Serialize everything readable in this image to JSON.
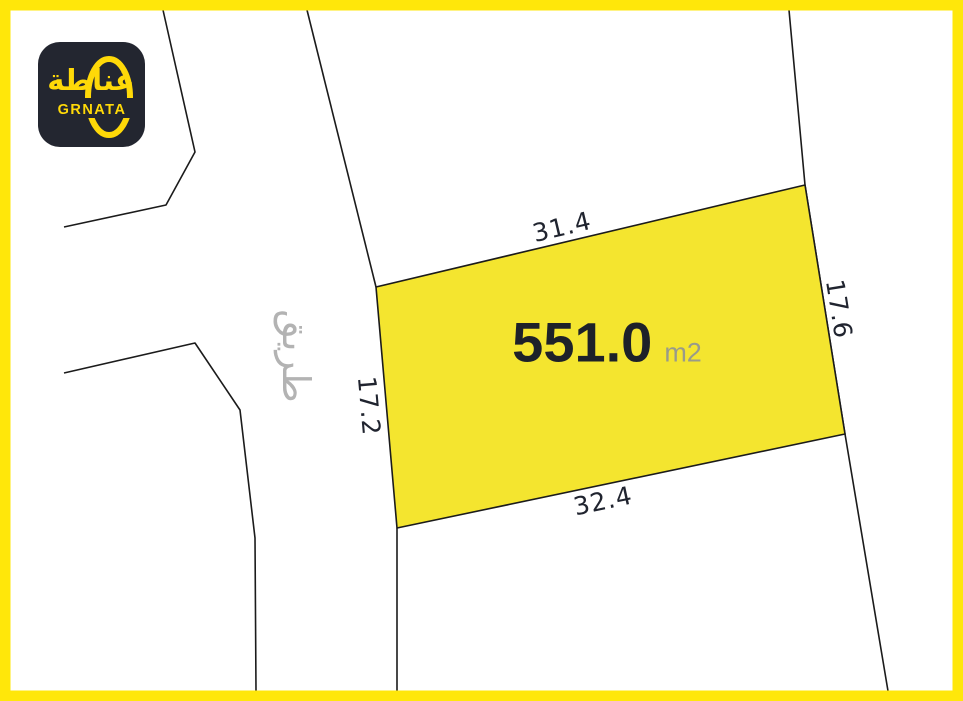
{
  "brand": {
    "arabic_name": "غناطة",
    "latin_name": "GRNATA"
  },
  "plot": {
    "area_value": "551.0",
    "area_unit": "m2",
    "dimensions": {
      "top": "31.4",
      "right": "17.6",
      "bottom": "32.4",
      "left": "17.2"
    }
  },
  "road": {
    "label": "طريق"
  },
  "colors": {
    "frame_yellow": "#FFE70A",
    "plot_fill": "#F4E52F",
    "boundary_line": "#1B1B1B",
    "area_text": "#1D2129",
    "unit_text": "#999B8A",
    "road_text": "#B3B3B3",
    "logo_background": "#232630",
    "logo_yellow": "#FFD908"
  }
}
